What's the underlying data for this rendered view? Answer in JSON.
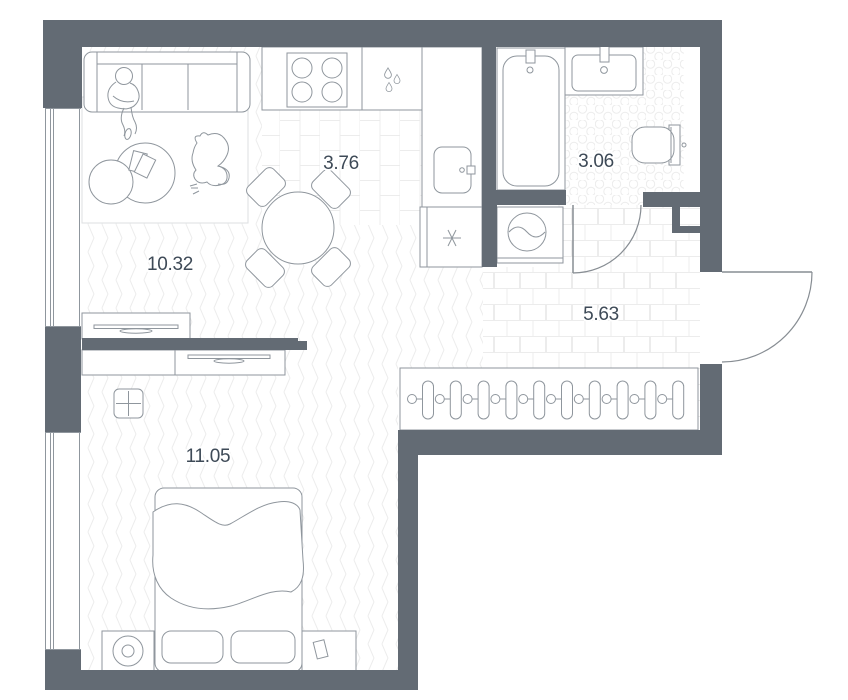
{
  "rooms": [
    {
      "name": "living-room",
      "area": "10.32"
    },
    {
      "name": "kitchen",
      "area": "3.76"
    },
    {
      "name": "bathroom",
      "area": "3.06"
    },
    {
      "name": "hallway",
      "area": "5.63"
    },
    {
      "name": "bedroom",
      "area": "11.05"
    }
  ],
  "colors": {
    "wall": "#636b74",
    "outline": "#8f969d",
    "label": "#3e4a57",
    "tile-line": "#ececec",
    "arc": "#878d93"
  },
  "icons": {
    "stove": "stove-burners-icon",
    "kitchen_sink": "water-drops-icon",
    "fridge": "snowflake-icon",
    "washer": "washing-machine-icon",
    "bathtub": "bathtub-icon",
    "washbasin": "washbasin-icon",
    "toilet": "toilet-icon",
    "wardrobe": "clothes-hangers-icon",
    "electricity": "electric-panel-icon",
    "tv": "tv-icon",
    "lamp": "lamp-icon"
  }
}
